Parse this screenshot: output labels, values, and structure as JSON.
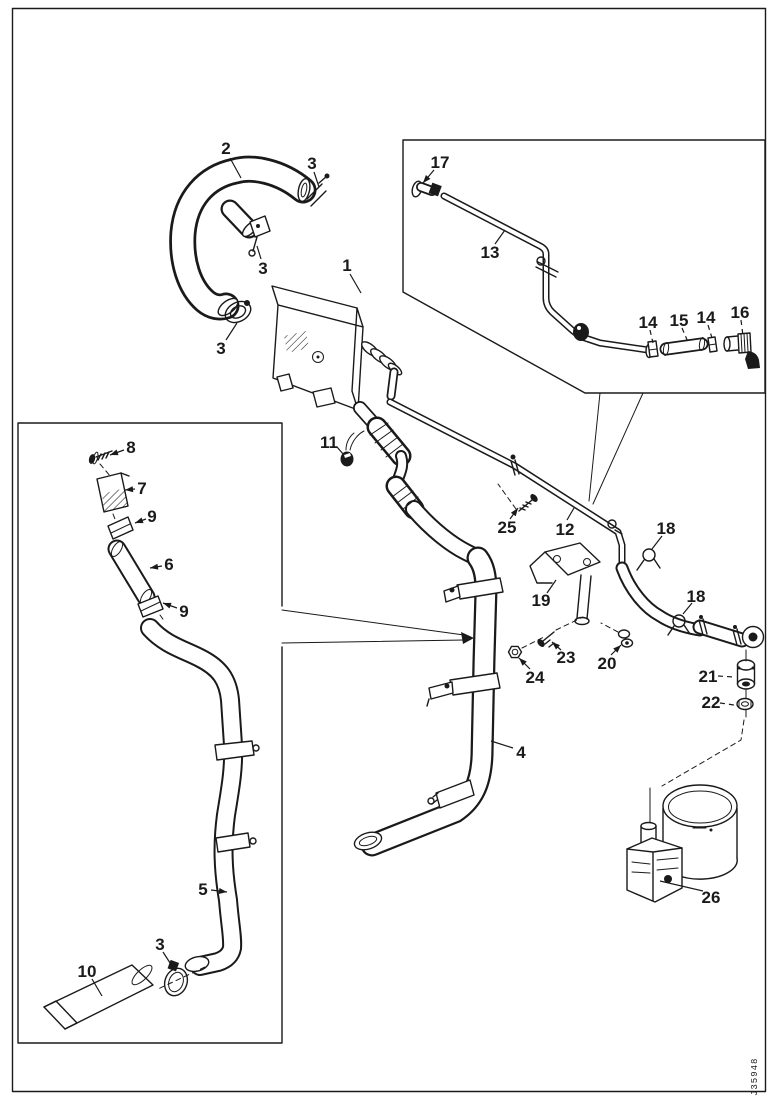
{
  "figure": {
    "code": "J35948"
  },
  "colors": {
    "line": "#1a1a1a",
    "background": "#ffffff"
  },
  "callouts": [
    {
      "label": "2",
      "x": 226,
      "y": 148,
      "sx": 230,
      "sy": 158,
      "tx": 241,
      "ty": 178,
      "style": "solid",
      "arrow": false
    },
    {
      "label": "3",
      "x": 312,
      "y": 163,
      "sx": 314,
      "sy": 172,
      "tx": 319,
      "ty": 187,
      "style": "solid",
      "arrow": false
    },
    {
      "label": "3",
      "x": 263,
      "y": 268,
      "sx": 261,
      "sy": 259,
      "tx": 257,
      "ty": 246,
      "style": "solid",
      "arrow": false
    },
    {
      "label": "3",
      "x": 221,
      "y": 348,
      "sx": 226,
      "sy": 340,
      "tx": 237,
      "ty": 323,
      "style": "solid",
      "arrow": false
    },
    {
      "label": "1",
      "x": 347,
      "y": 265,
      "sx": 350,
      "sy": 274,
      "tx": 361,
      "ty": 293,
      "style": "solid",
      "arrow": false
    },
    {
      "label": "17",
      "x": 440,
      "y": 162,
      "sx": 434,
      "sy": 170,
      "tx": 423,
      "ty": 183,
      "style": "solid",
      "arrow": true
    },
    {
      "label": "13",
      "x": 490,
      "y": 252,
      "sx": 495,
      "sy": 244,
      "tx": 505,
      "ty": 230,
      "style": "solid",
      "arrow": false
    },
    {
      "label": "14",
      "x": 648,
      "y": 322,
      "sx": 650,
      "sy": 330,
      "tx": 653,
      "ty": 343,
      "style": "dashed",
      "arrow": false
    },
    {
      "label": "15",
      "x": 679,
      "y": 320,
      "sx": 682,
      "sy": 328,
      "tx": 688,
      "ty": 342,
      "style": "dashed",
      "arrow": false
    },
    {
      "label": "14",
      "x": 706,
      "y": 317,
      "sx": 708,
      "sy": 325,
      "tx": 712,
      "ty": 338,
      "style": "dashed",
      "arrow": false
    },
    {
      "label": "16",
      "x": 740,
      "y": 312,
      "sx": 741,
      "sy": 320,
      "tx": 743,
      "ty": 336,
      "style": "dashed",
      "arrow": false
    },
    {
      "label": "11",
      "x": 329,
      "y": 442,
      "sx": 337,
      "sy": 447,
      "tx": 344,
      "ty": 455,
      "style": "solid",
      "arrow": false
    },
    {
      "label": "25",
      "x": 507,
      "y": 527,
      "sx": 510,
      "sy": 519,
      "tx": 518,
      "ty": 508,
      "style": "solid",
      "arrow": true
    },
    {
      "label": "12",
      "x": 565,
      "y": 529,
      "sx": 567,
      "sy": 520,
      "tx": 574,
      "ty": 508,
      "style": "solid",
      "arrow": false
    },
    {
      "label": "19",
      "x": 541,
      "y": 600,
      "sx": 547,
      "sy": 593,
      "tx": 556,
      "ty": 580,
      "style": "solid",
      "arrow": false
    },
    {
      "label": "18",
      "x": 666,
      "y": 528,
      "sx": 662,
      "sy": 536,
      "tx": 652,
      "ty": 549,
      "style": "solid",
      "arrow": false
    },
    {
      "label": "18",
      "x": 696,
      "y": 596,
      "sx": 692,
      "sy": 603,
      "tx": 683,
      "ty": 614,
      "style": "solid",
      "arrow": false
    },
    {
      "label": "23",
      "x": 566,
      "y": 657,
      "sx": 561,
      "sy": 650,
      "tx": 552,
      "ty": 642,
      "style": "solid",
      "arrow": true
    },
    {
      "label": "20",
      "x": 607,
      "y": 663,
      "sx": 611,
      "sy": 655,
      "tx": 621,
      "ty": 645,
      "style": "solid",
      "arrow": true
    },
    {
      "label": "24",
      "x": 535,
      "y": 677,
      "sx": 530,
      "sy": 669,
      "tx": 519,
      "ty": 658,
      "style": "solid",
      "arrow": true
    },
    {
      "label": "4",
      "x": 521,
      "y": 752,
      "sx": 513,
      "sy": 748,
      "tx": 491,
      "ty": 741,
      "style": "solid",
      "arrow": false
    },
    {
      "label": "21",
      "x": 708,
      "y": 676,
      "sx": 718,
      "sy": 676,
      "tx": 734,
      "ty": 677,
      "style": "dashed",
      "arrow": false
    },
    {
      "label": "22",
      "x": 711,
      "y": 702,
      "sx": 720,
      "sy": 703,
      "tx": 734,
      "ty": 705,
      "style": "dashed",
      "arrow": false
    },
    {
      "label": "26",
      "x": 711,
      "y": 897,
      "sx": 703,
      "sy": 891,
      "tx": 660,
      "ty": 881,
      "style": "solid",
      "arrow": false
    },
    {
      "label": "8",
      "x": 131,
      "y": 447,
      "sx": 124,
      "sy": 450,
      "tx": 110,
      "ty": 455,
      "style": "solid",
      "arrow": true
    },
    {
      "label": "7",
      "x": 142,
      "y": 488,
      "sx": 135,
      "sy": 489,
      "tx": 125,
      "ty": 490,
      "style": "solid",
      "arrow": true
    },
    {
      "label": "9",
      "x": 152,
      "y": 516,
      "sx": 146,
      "sy": 519,
      "tx": 135,
      "ty": 523,
      "style": "solid",
      "arrow": true
    },
    {
      "label": "6",
      "x": 169,
      "y": 564,
      "sx": 162,
      "sy": 566,
      "tx": 150,
      "ty": 568,
      "style": "solid",
      "arrow": true
    },
    {
      "label": "9",
      "x": 184,
      "y": 611,
      "sx": 177,
      "sy": 608,
      "tx": 163,
      "ty": 603,
      "style": "solid",
      "arrow": true
    },
    {
      "label": "5",
      "x": 203,
      "y": 889,
      "sx": 211,
      "sy": 890,
      "tx": 227,
      "ty": 892,
      "style": "solid",
      "arrow": true
    },
    {
      "label": "3",
      "x": 160,
      "y": 944,
      "sx": 163,
      "sy": 952,
      "tx": 172,
      "ty": 966,
      "style": "solid",
      "arrow": false
    },
    {
      "label": "10",
      "x": 87,
      "y": 971,
      "sx": 92,
      "sy": 979,
      "tx": 102,
      "ty": 996,
      "style": "solid",
      "arrow": false
    }
  ]
}
